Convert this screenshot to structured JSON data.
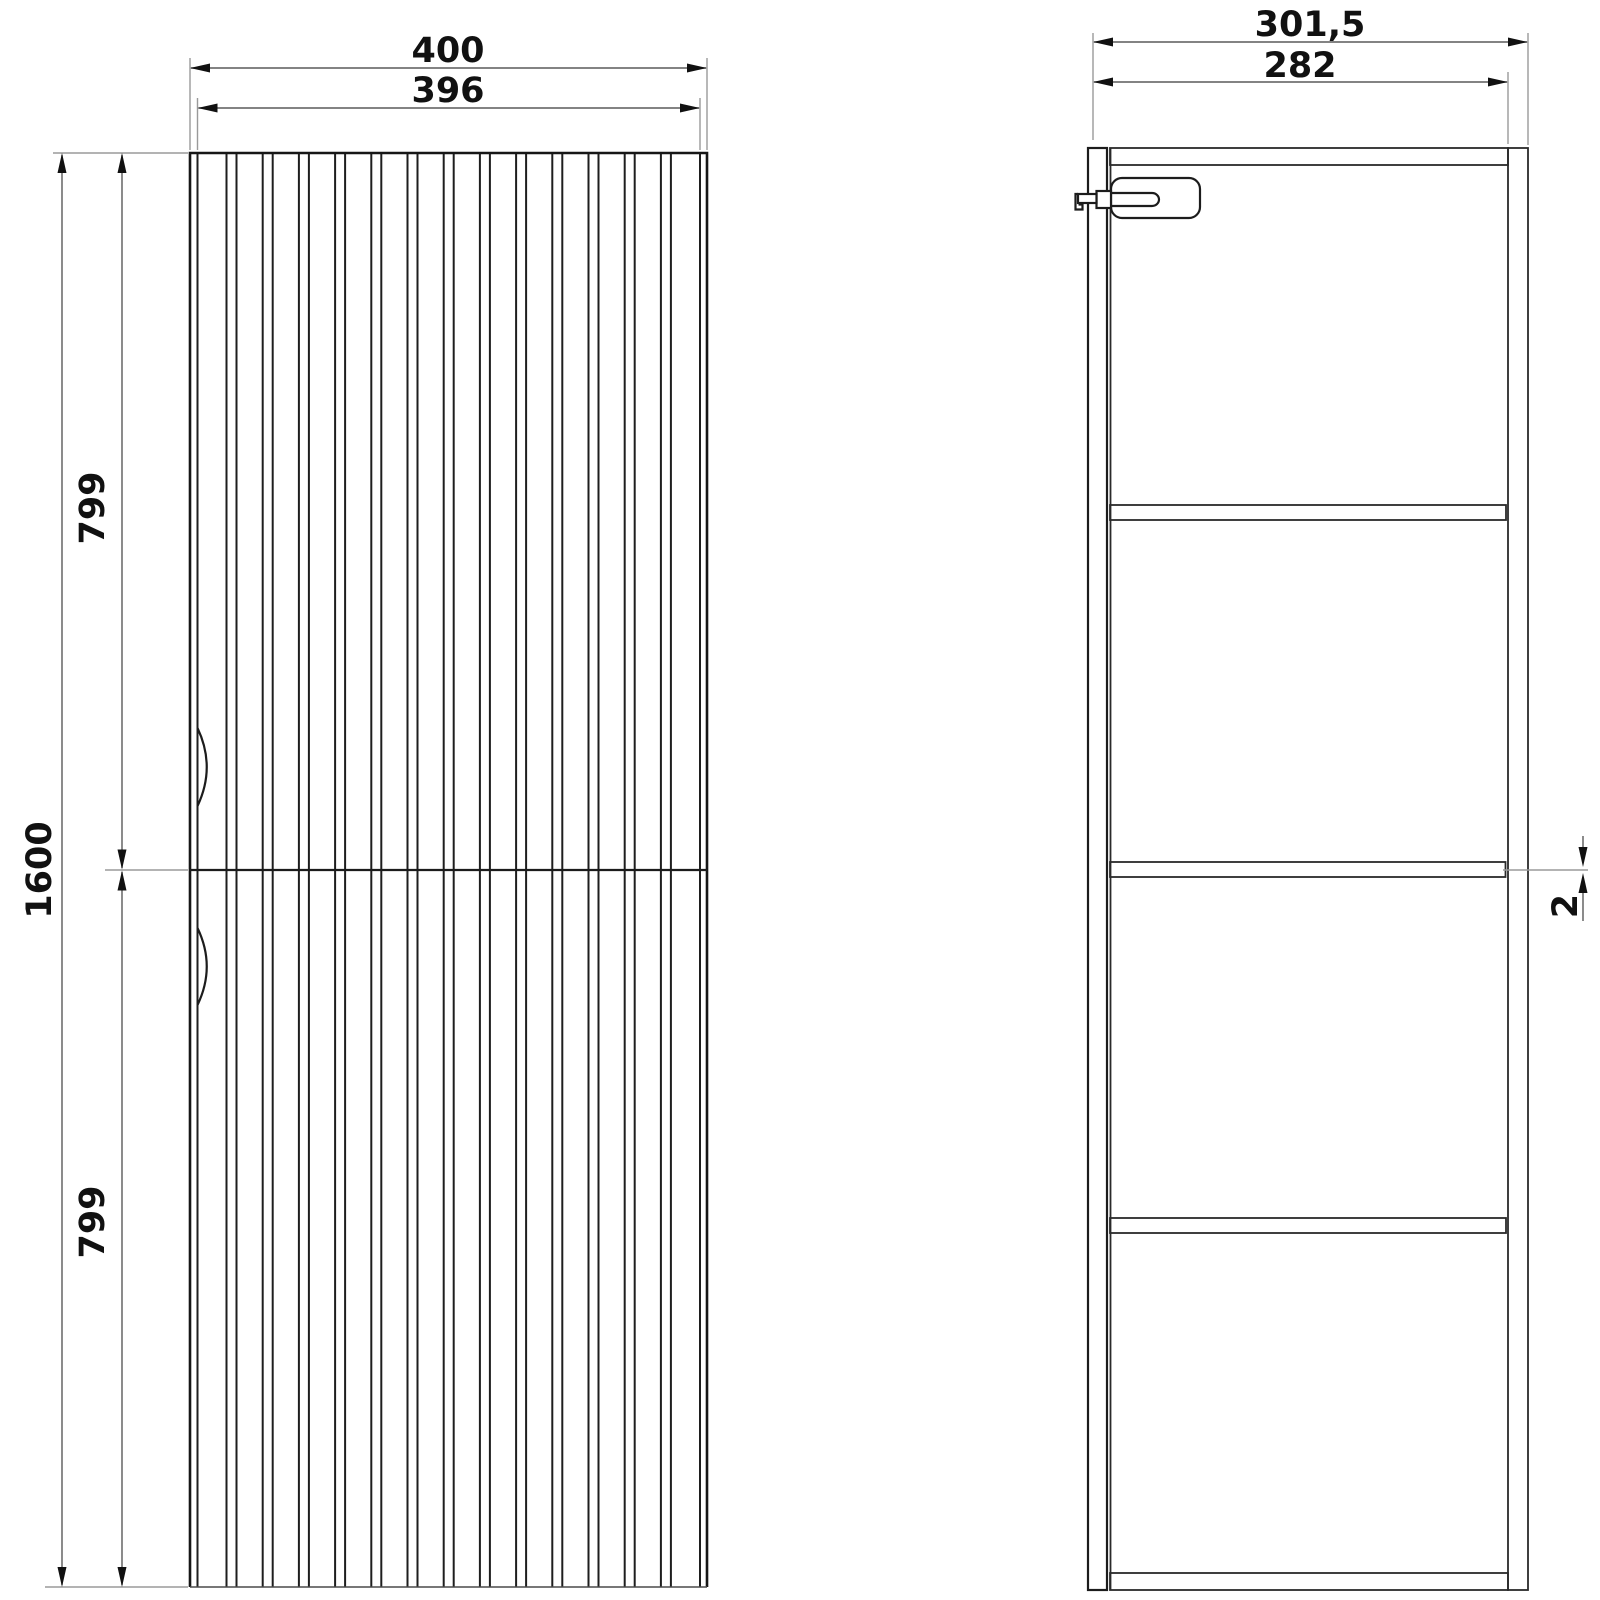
{
  "drawing": {
    "front_view": {
      "width_overall": "400",
      "width_door": "396",
      "height_overall": "1600",
      "height_upper_door": "799",
      "height_lower_door": "799"
    },
    "side_view": {
      "depth_overall": "301,5",
      "depth_body": "282",
      "back_gap": "2"
    }
  }
}
